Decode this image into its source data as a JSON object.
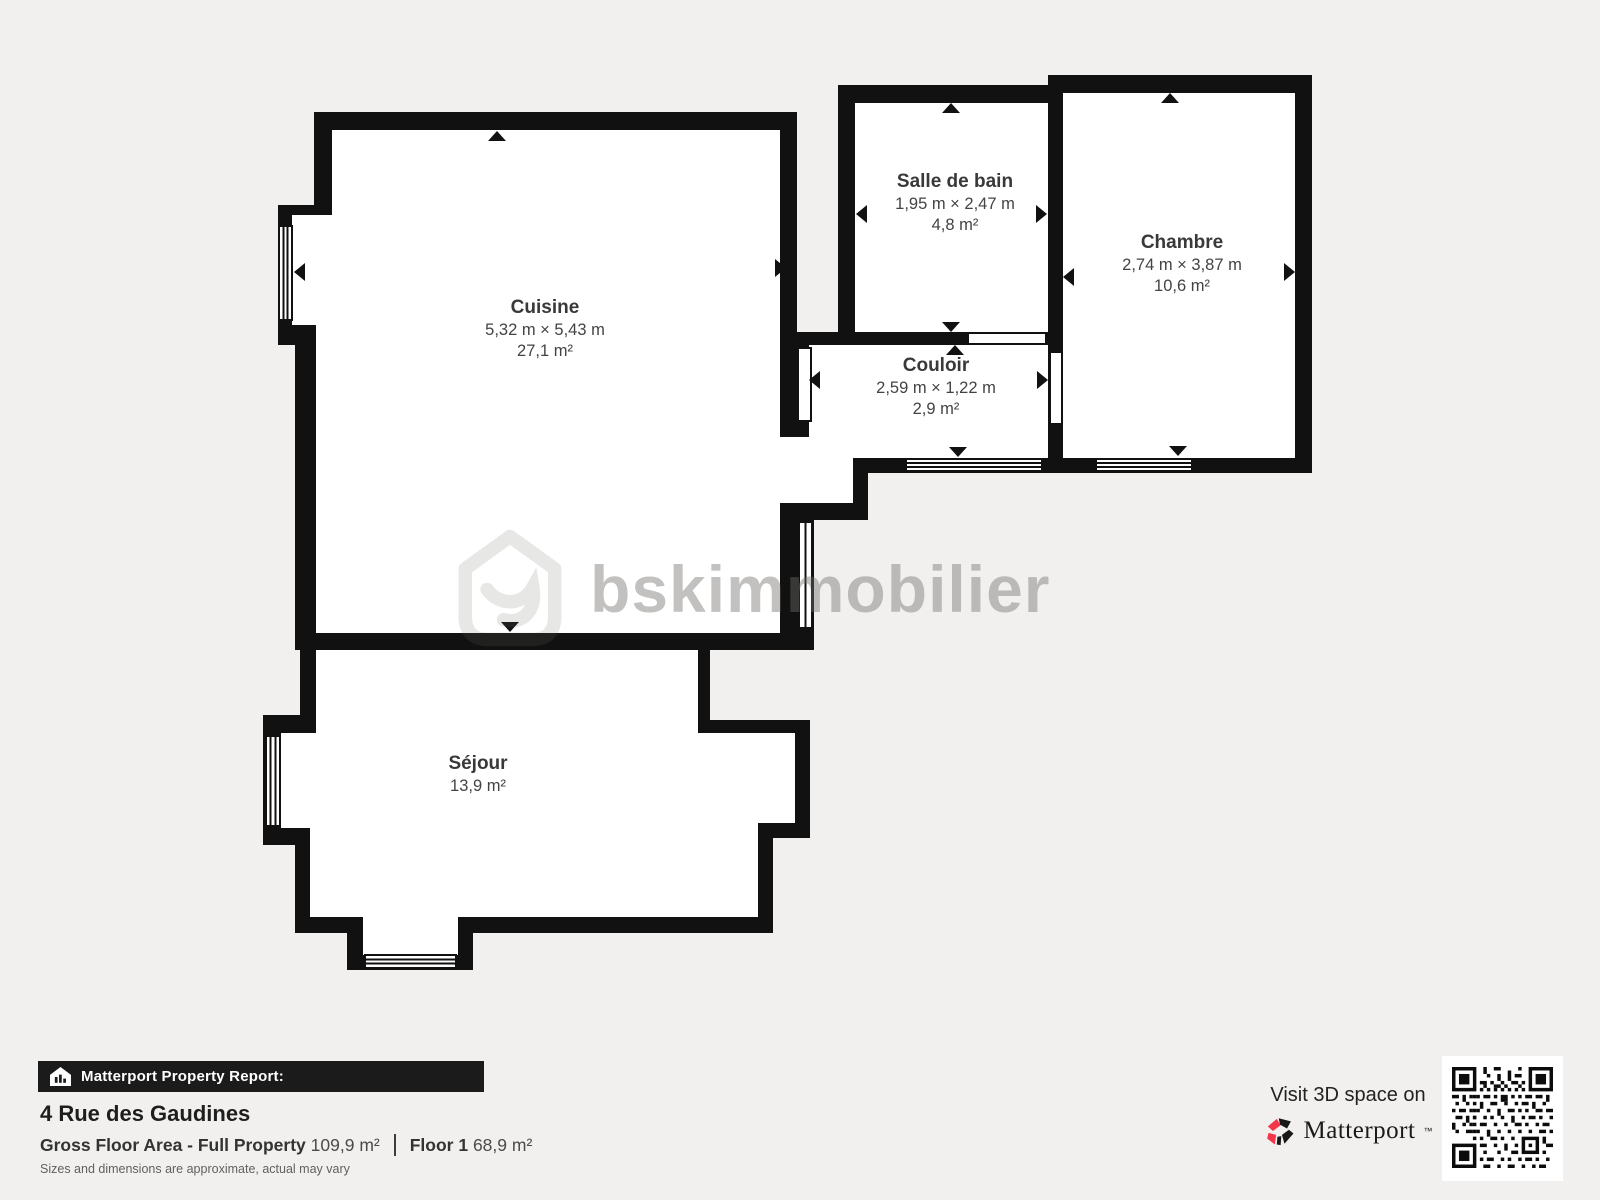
{
  "plan": {
    "rooms": [
      {
        "name": "Cuisine",
        "dimensions": "5,32 m × 5,43 m",
        "area": "27,1 m²"
      },
      {
        "name": "Salle de bain",
        "dimensions": "1,95 m × 2,47 m",
        "area": "4,8 m²"
      },
      {
        "name": "Chambre",
        "dimensions": "2,74 m × 3,87 m",
        "area": "10,6 m²"
      },
      {
        "name": "Couloir",
        "dimensions": "2,59 m × 1,22 m",
        "area": "2,9 m²"
      },
      {
        "name": "Séjour",
        "area": "13,9 m²"
      }
    ]
  },
  "watermark": {
    "text": "bskimmobilier"
  },
  "report": {
    "banner": "Matterport Property Report:",
    "address": "4 Rue des Gaudines",
    "gross_label": "Gross Floor Area - Full Property",
    "gross_value": "109,9 m²",
    "floor_label": "Floor 1",
    "floor_value": "68,9 m²",
    "disclaimer": "Sizes and dimensions are approximate, actual may vary"
  },
  "cta": {
    "visit": "Visit 3D space on",
    "brand": "Matterport",
    "trademark": "™"
  },
  "colors": {
    "wall": "#111111",
    "background": "#f1f0ee",
    "accent_pink": "#f4364c"
  }
}
